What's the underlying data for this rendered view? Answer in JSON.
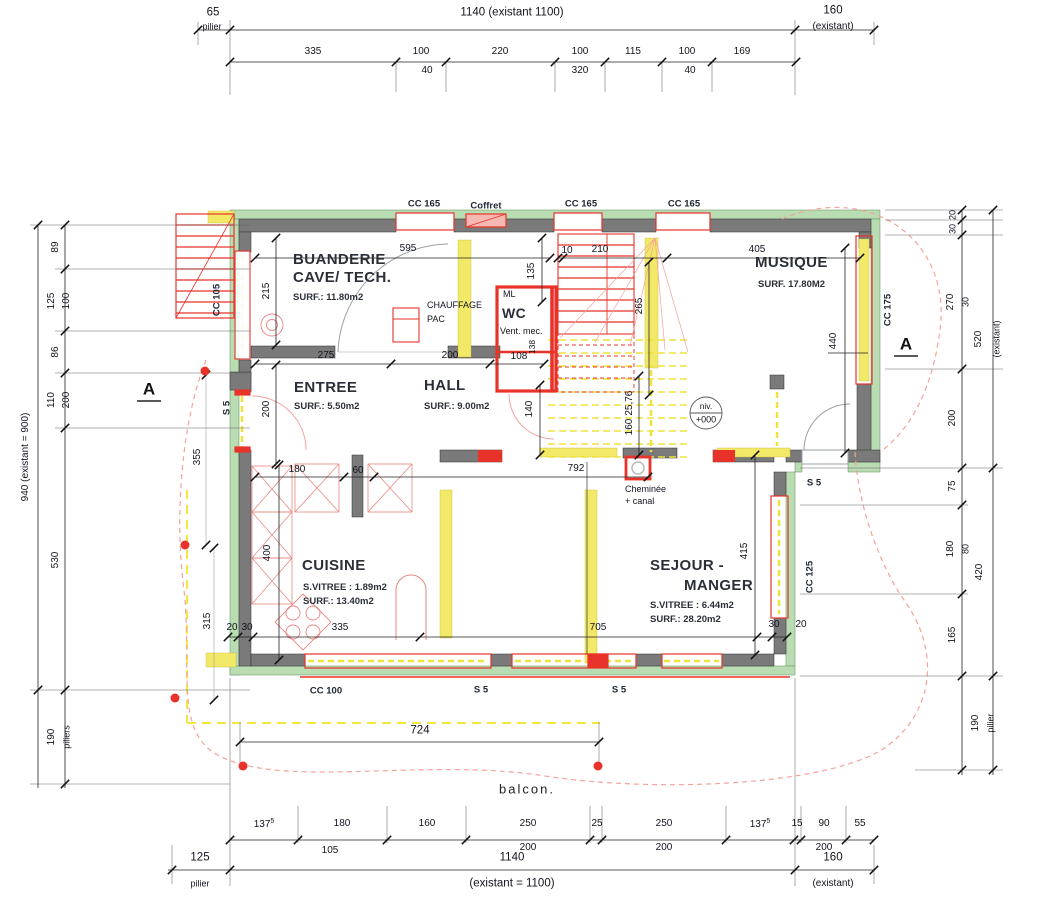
{
  "dims_top": {
    "pilier": {
      "value": "65",
      "label": "pilier"
    },
    "overall": "1140 (existant 1100)",
    "right": {
      "value": "160",
      "label": "(existant)"
    },
    "row": [
      "335",
      "100",
      "220",
      "100",
      "115",
      "100",
      "169"
    ],
    "row_sub": [
      "40",
      "320",
      "40"
    ]
  },
  "dims_left": {
    "overall": "940 (existant = 900)",
    "seg89": "89",
    "seg125": "125",
    "sec100": "100",
    "seg86": "86",
    "seg110": "110",
    "sec200": "200",
    "seg530": "530",
    "pilier": {
      "value": "190",
      "label": "piliers"
    }
  },
  "dims_right": {
    "seg20": "20",
    "seg30": "30",
    "seg270": "270",
    "sec30": "30",
    "overall_upper": "520",
    "overall_upper_note": "(existant)",
    "seg200": "200",
    "seg75": "75",
    "seg180": "180",
    "sec80": "80",
    "seg165": "165",
    "overall_lower": "420",
    "pilier": {
      "value": "190",
      "label": "pilier"
    }
  },
  "dims_bottom": {
    "balcony_width": "724",
    "balcon_label": "balcon.",
    "row": [
      "137",
      "180",
      "160",
      "250",
      "25",
      "250",
      "137",
      "15",
      "90",
      "55"
    ],
    "sup": "5",
    "sub": [
      "105",
      "200",
      "200",
      "200"
    ],
    "pilier": {
      "value": "125",
      "label": "pilier"
    },
    "overall": {
      "value": "1140",
      "note": "(existant = 1100)"
    },
    "right": {
      "value": "160",
      "note": "(existant)"
    }
  },
  "rooms": {
    "buanderie": {
      "name": "BUANDERIE",
      "name2": "CAVE/ TECH.",
      "surf": "SURF.: 11.80m2"
    },
    "musique": {
      "name": "MUSIQUE",
      "surf": "SURF. 17.80M2"
    },
    "entree": {
      "name": "ENTREE",
      "surf": "SURF.: 5.50m2"
    },
    "hall": {
      "name": "HALL",
      "surf": "SURF.: 9.00m2"
    },
    "wc": {
      "name": "WC",
      "vent": "Vent. mec.",
      "ml": "ML"
    },
    "cuisine": {
      "name": "CUISINE",
      "vitree": "S.VITREE : 1.89m2",
      "surf": "SURF.: 13.40m2"
    },
    "sejour": {
      "name": "SEJOUR -",
      "name2": "MANGER",
      "vitree": "S.VITREE : 6.44m2",
      "surf": "SURF.: 28.20m2"
    }
  },
  "annotations": {
    "chauffage1": "CHAUFFAGE",
    "chauffage2": "PAC",
    "coffret": "Coffret",
    "cheminee1": "Cheminée",
    "cheminee2": "+ canal",
    "niv1": "niv.",
    "niv2": "+000",
    "section": "A",
    "cc165": "CC 165",
    "cc105": "CC 105",
    "cc175": "CC 175",
    "cc125": "CC 125",
    "cc100": "CC 100",
    "s5": "S 5"
  },
  "dims_interior": {
    "w595": "595",
    "w215": "215",
    "w275": "275",
    "w200a": "200",
    "w108": "108",
    "w135": "135",
    "w138": "138",
    "w10": "10",
    "w210": "210",
    "w405": "405",
    "w265": "265",
    "w440": "440",
    "w200b": "200",
    "w140": "140",
    "w180": "180",
    "w60": "60",
    "w792": "792",
    "w160": "160",
    "w2576": "25,76",
    "w415": "415",
    "w400": "400",
    "w335": "335",
    "w705": "705",
    "w20a": "20",
    "w30a": "30",
    "w30b": "30",
    "w20b": "20",
    "w355": "355",
    "w315": "315"
  },
  "colors": {
    "wall_new_grey": "#7a7a7a",
    "wall_existing_green": "#b9dcb2",
    "demolish_yellow": "#f3e969",
    "new_red": "#e8332a",
    "survey_pink": "#f4a29b"
  }
}
